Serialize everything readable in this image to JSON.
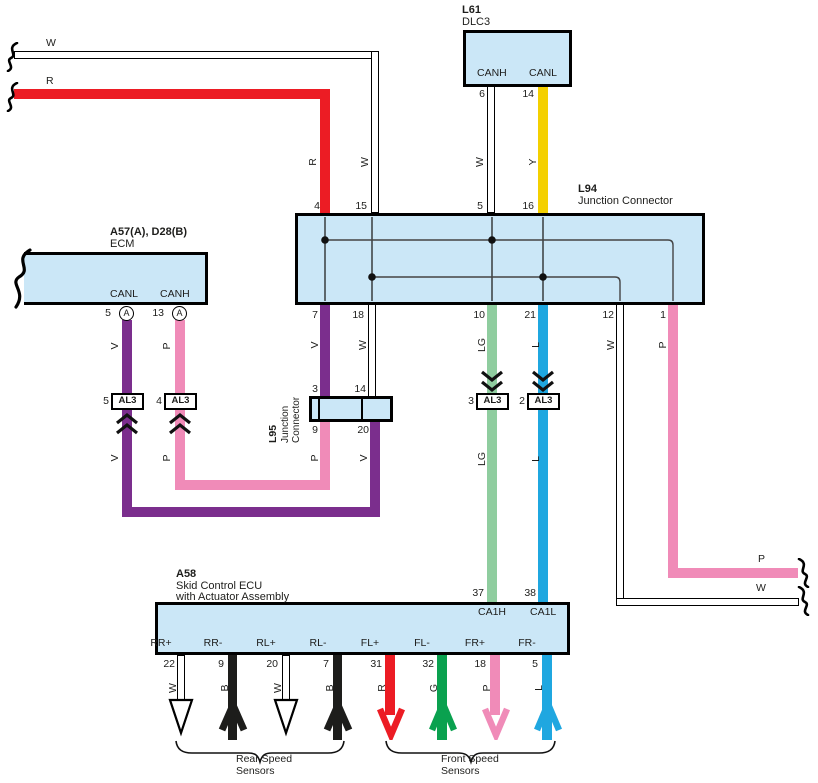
{
  "colors": {
    "red": "#EC1C24",
    "yellow": "#F4D000",
    "purple": "#7B2E8D",
    "pink": "#F08BB8",
    "light_green": "#8FCD9F",
    "light_blue": "#1FA7E0",
    "green": "#0AA14F",
    "black": "#1D1D1B",
    "connector_fill": "#CBE7F7"
  },
  "breakout": {
    "top_w": "W",
    "top_r": "R",
    "right_p": "P",
    "right_w": "W"
  },
  "dlc3": {
    "code": "L61",
    "name": "DLC3",
    "canh": "CANH",
    "canl": "CANL",
    "pin_canh": "6",
    "pin_canl": "14",
    "wire_canh": "W",
    "wire_canl": "Y",
    "l94_pin_canh": "5",
    "l94_pin_canl": "16"
  },
  "l94": {
    "code": "L94",
    "name": "Junction Connector",
    "pin_top_r": "4",
    "pin_top_w": "15",
    "pin_b_7": "7",
    "pin_b_18": "18",
    "pin_b_10": "10",
    "pin_b_21": "21",
    "pin_b_12": "12",
    "pin_b_1": "1",
    "wire_r": "R",
    "wire_w": "W",
    "wire_v": "V",
    "wire_w18": "W",
    "wire_lg": "LG",
    "wire_l": "L",
    "wire_w12": "W",
    "wire_p1": "P"
  },
  "l55": {
    "code": "L95",
    "name_line1": "Junction",
    "name_line2": "Connector",
    "pin_t_l": "3",
    "pin_t_r": "14",
    "pin_b_l": "9",
    "pin_b_r": "20",
    "wire_riser_p": "P",
    "wire_riser_v": "V"
  },
  "ecm": {
    "code": "A57(A), D28(B)",
    "name": "ECM",
    "canl": "CANL",
    "canh": "CANH",
    "pin_canl": "5",
    "pin_canh": "13",
    "conn_letter": "A",
    "wire_v_upper": "V",
    "wire_p_upper": "P",
    "wire_v_lower": "V",
    "wire_p_lower": "P"
  },
  "al3": {
    "label": "AL3",
    "pin_ecm_left": "5",
    "pin_ecm_right": "4",
    "pin_mid_left": "3",
    "pin_mid_right": "2"
  },
  "mid_wires": {
    "lg_lower": "LG",
    "l_lower": "L"
  },
  "a58": {
    "code": "A58",
    "name_line1": "Skid Control ECU",
    "name_line2": "with Actuator Assembly",
    "pin_ca1h": "37",
    "pin_ca1l": "38",
    "ca1h": "CA1H",
    "ca1l": "CA1L",
    "bottom_pins": [
      {
        "no": "22",
        "label": "RR+",
        "wire": "W"
      },
      {
        "no": "9",
        "label": "RR-",
        "wire": "B"
      },
      {
        "no": "20",
        "label": "RL+",
        "wire": "W"
      },
      {
        "no": "7",
        "label": "RL-",
        "wire": "B"
      },
      {
        "no": "31",
        "label": "FL+",
        "wire": "R"
      },
      {
        "no": "32",
        "label": "FL-",
        "wire": "G"
      },
      {
        "no": "18",
        "label": "FR+",
        "wire": "P"
      },
      {
        "no": "5",
        "label": "FR-",
        "wire": "L"
      }
    ]
  },
  "groups": {
    "rear_line1": "Rear Speed",
    "rear_line2": "Sensors",
    "front_line1": "Front Speed",
    "front_line2": "Sensors"
  }
}
